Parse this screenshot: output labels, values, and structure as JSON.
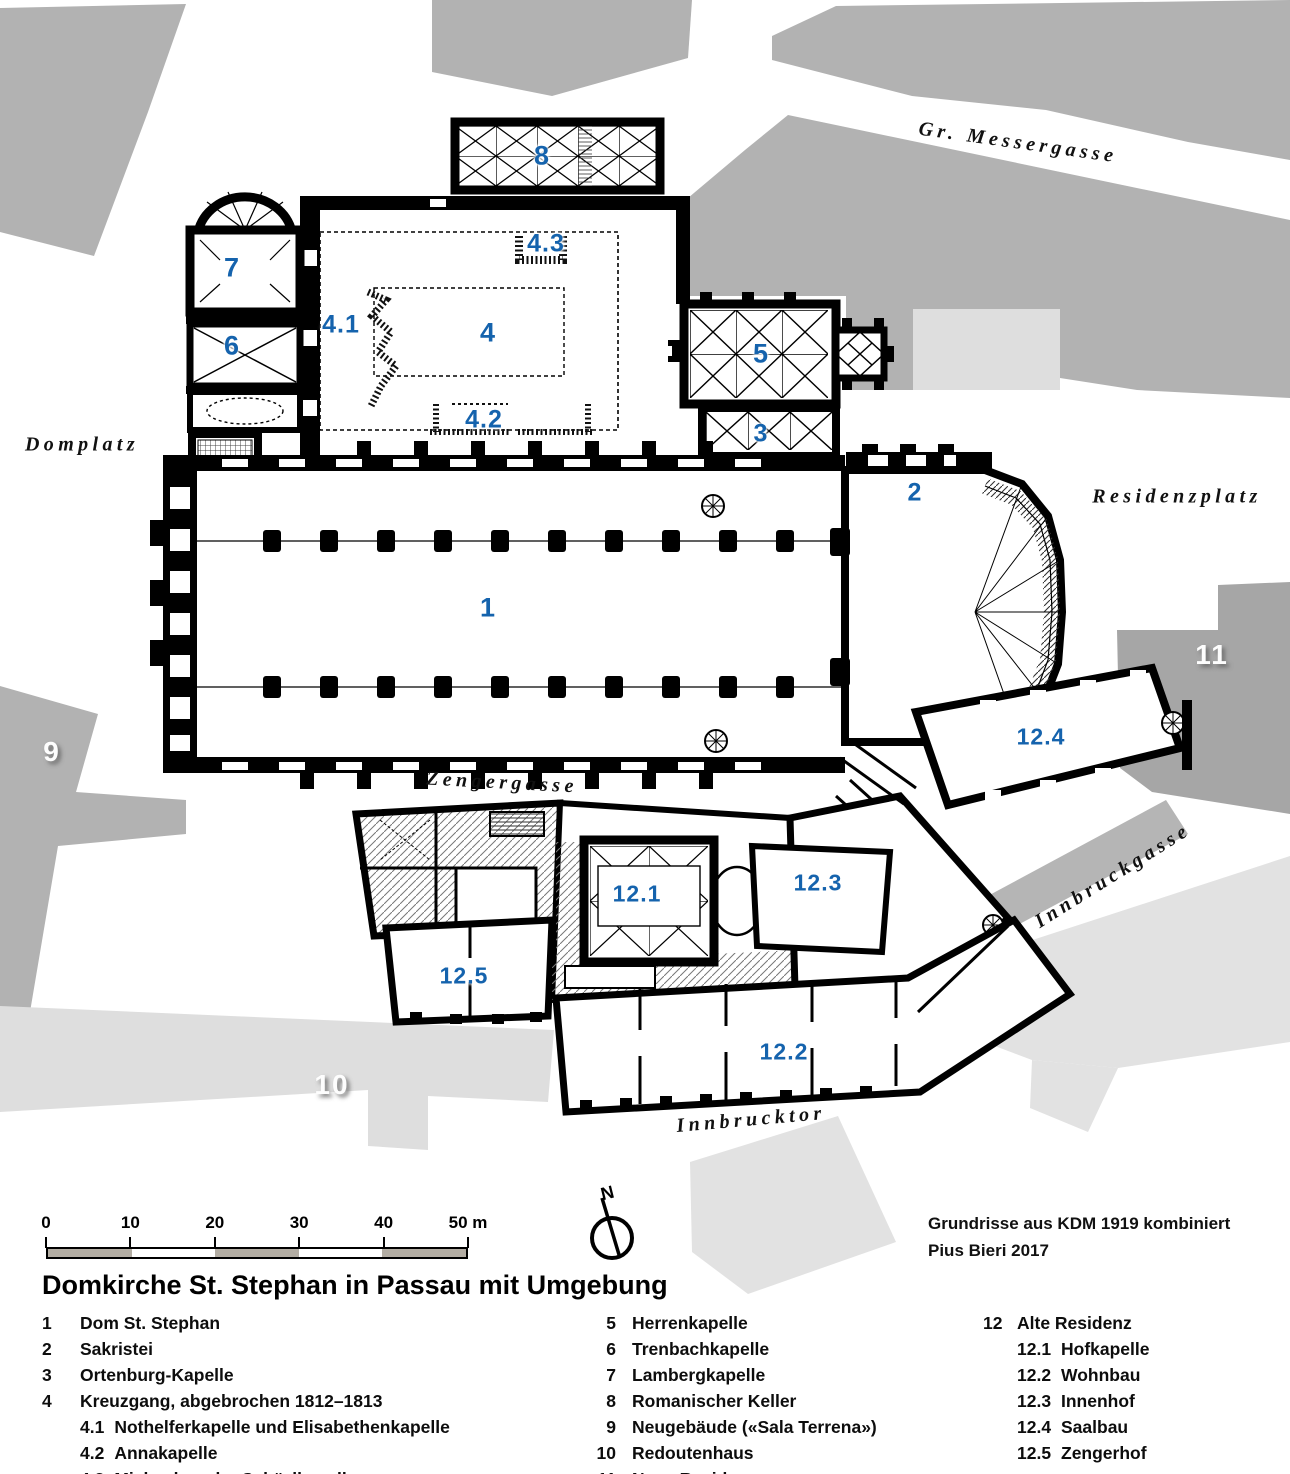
{
  "title": "Domkirche St. Stephan in Passau mit Umgebung",
  "credits": [
    "Grundrisse aus KDM 1919 kombiniert",
    "Pius Bieri 2017"
  ],
  "north_label": "N",
  "scale_bar": {
    "tick_labels": [
      "0",
      "10",
      "20",
      "30",
      "40",
      "50 m"
    ]
  },
  "streets": [
    {
      "name": "Gr. Messergasse",
      "x": 1018,
      "y": 143,
      "angle": 8
    },
    {
      "name": "Domplatz",
      "x": 82,
      "y": 445,
      "angle": 0
    },
    {
      "name": "Residenzplatz",
      "x": 1177,
      "y": 497,
      "angle": 0
    },
    {
      "name": "Zengergasse",
      "x": 502,
      "y": 783,
      "angle": 3
    },
    {
      "name": "Innbruckgasse",
      "x": 1113,
      "y": 876,
      "angle": -32
    },
    {
      "name": "Innbrucktor",
      "x": 751,
      "y": 1120,
      "angle": -5
    }
  ],
  "plan_labels": [
    {
      "id": "8",
      "x": 542,
      "y": 156,
      "size": 27
    },
    {
      "id": "7",
      "x": 232,
      "y": 268,
      "size": 27
    },
    {
      "id": "6",
      "x": 232,
      "y": 346,
      "size": 27
    },
    {
      "id": "4.3",
      "x": 546,
      "y": 244,
      "size": 25
    },
    {
      "id": "4.1",
      "x": 341,
      "y": 325,
      "size": 25
    },
    {
      "id": "4",
      "x": 488,
      "y": 333,
      "size": 27
    },
    {
      "id": "5",
      "x": 761,
      "y": 354,
      "size": 27
    },
    {
      "id": "4.2",
      "x": 484,
      "y": 420,
      "size": 25
    },
    {
      "id": "3",
      "x": 761,
      "y": 434,
      "size": 25
    },
    {
      "id": "2",
      "x": 915,
      "y": 493,
      "size": 25
    },
    {
      "id": "1",
      "x": 488,
      "y": 608,
      "size": 27
    },
    {
      "id": "12.4",
      "x": 1041,
      "y": 737,
      "size": 23
    },
    {
      "id": "12.1",
      "x": 637,
      "y": 894,
      "size": 23
    },
    {
      "id": "12.3",
      "x": 818,
      "y": 883,
      "size": 23
    },
    {
      "id": "12.5",
      "x": 464,
      "y": 976,
      "size": 23
    },
    {
      "id": "12.2",
      "x": 784,
      "y": 1052,
      "size": 23
    }
  ],
  "area_labels": [
    {
      "id": "9",
      "x": 52,
      "y": 752
    },
    {
      "id": "10",
      "x": 332,
      "y": 1085
    },
    {
      "id": "11",
      "x": 1212,
      "y": 655
    }
  ],
  "legend": {
    "columns": [
      {
        "entries": [
          {
            "num": "1",
            "label": "Dom St. Stephan",
            "indent": false
          },
          {
            "num": "2",
            "label": "Sakristei",
            "indent": false
          },
          {
            "num": "3",
            "label": "Ortenburg-Kapelle",
            "indent": false
          },
          {
            "num": "4",
            "label": "Kreuzgang, abgebrochen 1812–1813",
            "indent": false
          },
          {
            "num": "4.1",
            "label": "Nothelferkapelle und Elisabethenkapelle",
            "indent": true
          },
          {
            "num": "4.2",
            "label": "Annakapelle",
            "indent": true
          },
          {
            "num": "4.3",
            "label": "Michaels- oder Schäzlkapelle",
            "indent": true
          }
        ]
      },
      {
        "entries": [
          {
            "num": "5",
            "label": "Herrenkapelle",
            "indent": false
          },
          {
            "num": "6",
            "label": "Trenbachkapelle",
            "indent": false
          },
          {
            "num": "7",
            "label": "Lambergkapelle",
            "indent": false
          },
          {
            "num": "8",
            "label": "Romanischer Keller",
            "indent": false
          },
          {
            "num": "9",
            "label": "Neugebäude («Sala Terrena»)",
            "indent": false
          },
          {
            "num": "10",
            "label": "Redoutenhaus",
            "indent": false
          },
          {
            "num": "11",
            "label": "Neue Residenz",
            "indent": false
          }
        ]
      },
      {
        "entries": [
          {
            "num": "12",
            "label": "Alte Residenz",
            "indent": false
          },
          {
            "num": "12.1",
            "label": "Hofkapelle",
            "indent": true
          },
          {
            "num": "12.2",
            "label": "Wohnbau",
            "indent": true
          },
          {
            "num": "12.3",
            "label": "Innenhof",
            "indent": true
          },
          {
            "num": "12.4",
            "label": "Saalbau",
            "indent": true
          },
          {
            "num": "12.5",
            "label": "Zengerhof",
            "indent": true
          }
        ]
      }
    ]
  },
  "colors": {
    "label_blue": "#1563ad",
    "medium_gray": "#b2b2b2",
    "light_gray": "#dedede",
    "dark_gray_block": "#a6a6a6",
    "scale_fill": "#b3ada3",
    "area_label_text": "#fdfdfd"
  }
}
